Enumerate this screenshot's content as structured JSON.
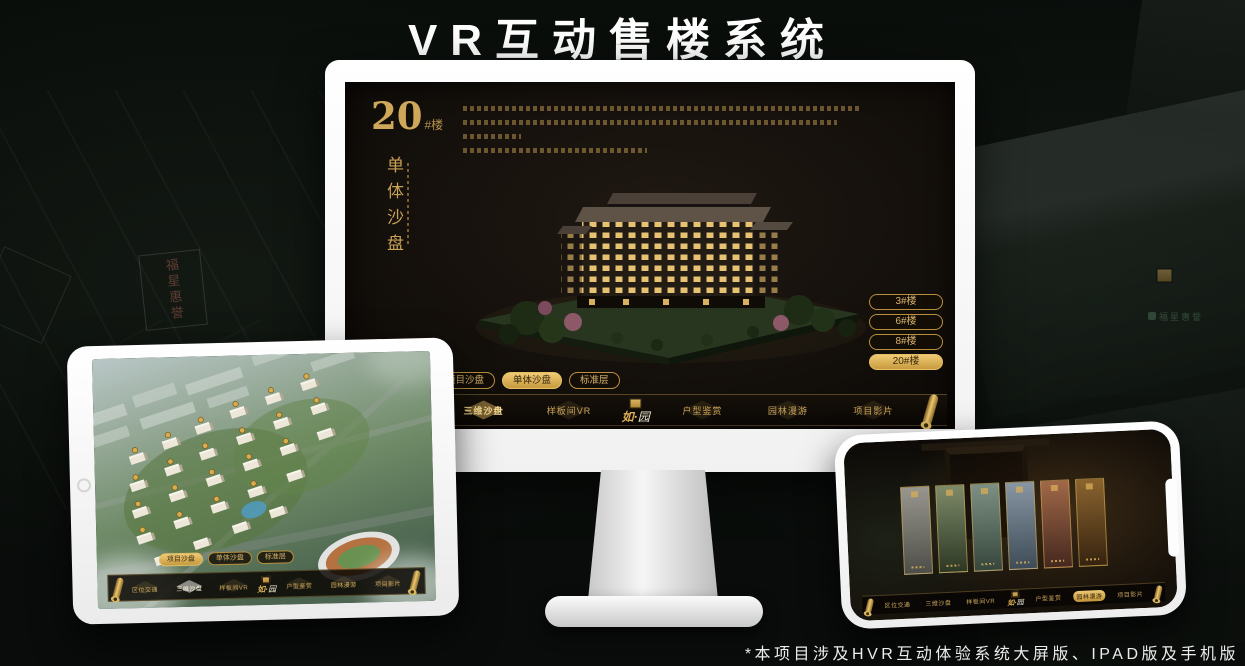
{
  "title": "VR互动售楼系统",
  "footnote": "*本项目涉及HVR互动体验系统大屏版、IPAD版及手机版",
  "logo": {
    "name_first": "如·",
    "name_second": "园"
  },
  "nav": {
    "items": [
      "区位交通",
      "三维沙盘",
      "样板间VR",
      "户型鉴赏",
      "园林漫游",
      "项目影片"
    ]
  },
  "tabs": {
    "items": [
      "项目沙盘",
      "单体沙盘",
      "标准层"
    ]
  },
  "desktop": {
    "heading": {
      "number": "20",
      "suffix": "#楼",
      "subtitle": "单体沙盘"
    },
    "active_tab": "单体沙盘",
    "building_buttons": [
      "3#楼",
      "6#楼",
      "8#楼",
      "20#楼"
    ],
    "active_building": "20#楼",
    "active_nav": "三维沙盘"
  },
  "tablet": {
    "active_tab": "项目沙盘",
    "active_nav": "三维沙盘"
  },
  "phone": {
    "active_nav": "园林漫游"
  },
  "watermarks": {
    "sign": "福星惠誉",
    "logo": "福星惠誉"
  },
  "colors": {
    "gold": "#c9a254",
    "screen_bg": "#16110c",
    "page_bg": "#0a0e0b"
  }
}
